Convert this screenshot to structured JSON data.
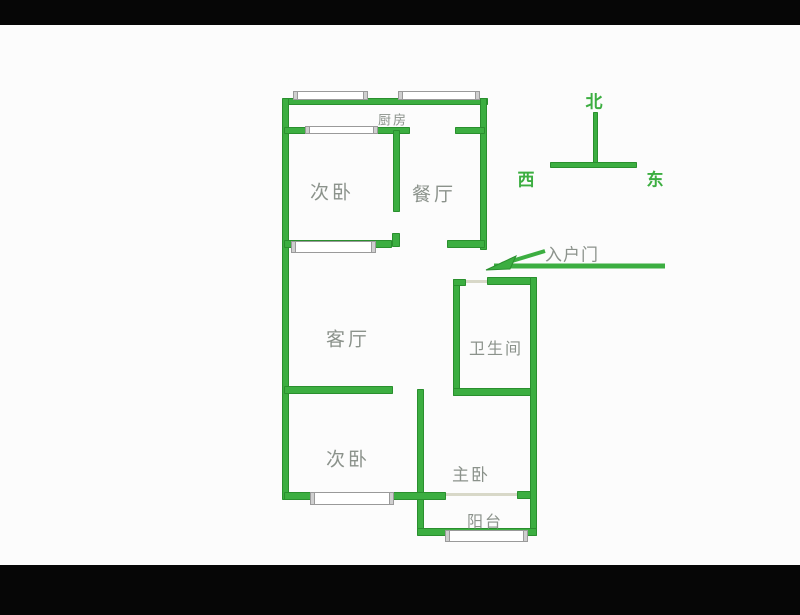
{
  "image": {
    "kind": "apartment-floor-plan-photo",
    "width": 800,
    "height": 615
  },
  "colors": {
    "wall_green": "#3cae41",
    "wall_green_dark": "#2a8f2e",
    "label_gray": "#8b928b",
    "door_line": "#d8d8c8",
    "window_border": "#9a9a9a",
    "background": "#fcfcfc",
    "letterbox": "#060606"
  },
  "labels": {
    "kitchen": "厨房",
    "bedroom_top": "次卧",
    "dining": "餐厅",
    "living": "客厅",
    "bathroom": "卫生间",
    "bedroom_bottom": "次卧",
    "master": "主卧",
    "balcony": "阳台",
    "entrance": "入户门"
  },
  "compass": {
    "north": "北",
    "west": "西",
    "east": "东"
  },
  "plan": {
    "walls": [
      {
        "name": "wall-outer-top",
        "x": 284,
        "y": 98,
        "w": 204,
        "h": 7
      },
      {
        "name": "wall-outer-left",
        "x": 282,
        "y": 98,
        "w": 7,
        "h": 402
      },
      {
        "name": "wall-outer-right-upper",
        "x": 480,
        "y": 98,
        "w": 7,
        "h": 152
      },
      {
        "name": "wall-kitchen-left",
        "x": 284,
        "y": 127,
        "w": 126,
        "h": 7
      },
      {
        "name": "wall-kitchen-right",
        "x": 455,
        "y": 127,
        "w": 30,
        "h": 7
      },
      {
        "name": "wall-divider-upper",
        "x": 393,
        "y": 130,
        "w": 7,
        "h": 82
      },
      {
        "name": "wall-divider-upper-stub",
        "x": 392,
        "y": 233,
        "w": 8,
        "h": 14
      },
      {
        "name": "wall-mid-left",
        "x": 284,
        "y": 240,
        "w": 108,
        "h": 8
      },
      {
        "name": "wall-mid-right",
        "x": 447,
        "y": 240,
        "w": 38,
        "h": 8
      },
      {
        "name": "wall-living-bottom",
        "x": 284,
        "y": 386,
        "w": 109,
        "h": 8
      },
      {
        "name": "wall-divider-lower",
        "x": 417,
        "y": 389,
        "w": 7,
        "h": 146
      },
      {
        "name": "wall-bedroom2-bottom",
        "x": 284,
        "y": 492,
        "w": 162,
        "h": 8
      },
      {
        "name": "wall-master-door-stub",
        "x": 517,
        "y": 491,
        "w": 18,
        "h": 8
      },
      {
        "name": "wall-bath-left",
        "x": 453,
        "y": 279,
        "w": 7,
        "h": 117
      },
      {
        "name": "wall-bath-top-stub",
        "x": 453,
        "y": 279,
        "w": 13,
        "h": 7
      },
      {
        "name": "wall-bath-top-right",
        "x": 487,
        "y": 277,
        "w": 50,
        "h": 8
      },
      {
        "name": "wall-bath-bottom",
        "x": 453,
        "y": 388,
        "w": 84,
        "h": 8
      },
      {
        "name": "wall-outer-right-lower",
        "x": 530,
        "y": 277,
        "w": 7,
        "h": 259
      },
      {
        "name": "wall-balcony-bottom",
        "x": 417,
        "y": 528,
        "w": 120,
        "h": 8
      },
      {
        "name": "compass-vertical-line",
        "x": 593,
        "y": 112,
        "w": 5,
        "h": 54
      },
      {
        "name": "compass-horizontal-line",
        "x": 550,
        "y": 162,
        "w": 87,
        "h": 6
      }
    ],
    "windows": [
      {
        "name": "window-top-left",
        "x": 293,
        "y": 91,
        "w": 75,
        "h": 9
      },
      {
        "name": "window-top-right",
        "x": 398,
        "y": 91,
        "w": 82,
        "h": 9
      },
      {
        "name": "window-kitchen",
        "x": 305,
        "y": 126,
        "w": 73,
        "h": 8
      },
      {
        "name": "window-living-top",
        "x": 291,
        "y": 241,
        "w": 85,
        "h": 12
      },
      {
        "name": "window-bedroom2",
        "x": 310,
        "y": 492,
        "w": 84,
        "h": 13
      },
      {
        "name": "window-balcony",
        "x": 445,
        "y": 530,
        "w": 83,
        "h": 12
      }
    ],
    "doors": [
      {
        "name": "door-bathroom",
        "x": 466,
        "y": 280,
        "w": 21,
        "h": 3
      },
      {
        "name": "door-master-balcony",
        "x": 446,
        "y": 493,
        "w": 71,
        "h": 3
      }
    ]
  }
}
